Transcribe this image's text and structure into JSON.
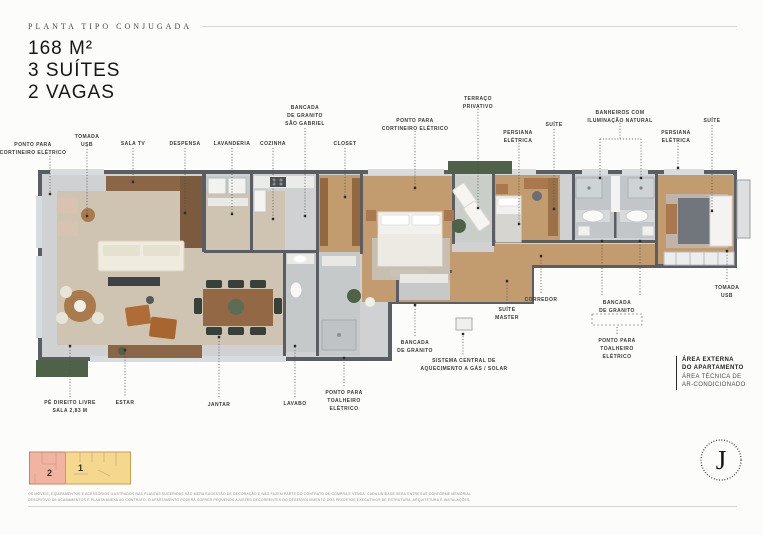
{
  "header": {
    "kicker": "PLANTA TIPO CONJUGADA",
    "area": "168 M²",
    "suites": "3 SUÍTES",
    "vagas": "2 VAGAS"
  },
  "palette": {
    "background": "#fcfcfa",
    "wall": "#5a5e62",
    "floor_gray": "#d0d1d2",
    "floor_bath": "#c6c9ca",
    "wood": "#c29b6e",
    "rug": "#cfc4b2",
    "sofa_cream": "#efebdf",
    "wood_furniture": "#9a6f45",
    "greenery": "#4e6247",
    "leader": "#4c4c4a",
    "keyplan_zone1": "#f6d78e",
    "keyplan_zone2": "#f1b4a0"
  },
  "callouts": [
    {
      "id": "ponto-cortineiro-eletrico-1",
      "lines": [
        "PONTO PARA",
        "CORTINEIRO ELÉTRICO"
      ],
      "x": 33,
      "y": 141,
      "segments": [
        [
          50,
          153,
          50,
          193
        ]
      ],
      "markers": [
        [
          50,
          194
        ]
      ]
    },
    {
      "id": "tomada-usb-1",
      "lines": [
        "TOMADA",
        "USB"
      ],
      "x": 87,
      "y": 133,
      "segments": [
        [
          87,
          146,
          87,
          215
        ]
      ],
      "markers": [
        [
          87,
          216
        ]
      ]
    },
    {
      "id": "sala-tv",
      "lines": [
        "SALA TV"
      ],
      "x": 133,
      "y": 140,
      "segments": [
        [
          133,
          148,
          133,
          181
        ]
      ],
      "markers": [
        [
          133,
          182
        ]
      ]
    },
    {
      "id": "despensa",
      "lines": [
        "DESPENSA"
      ],
      "x": 185,
      "y": 140,
      "segments": [
        [
          185,
          148,
          185,
          212
        ]
      ],
      "markers": [
        [
          185,
          213
        ]
      ]
    },
    {
      "id": "lavanderia",
      "lines": [
        "LAVANDERIA"
      ],
      "x": 232,
      "y": 140,
      "segments": [
        [
          232,
          148,
          232,
          213
        ]
      ],
      "markers": [
        [
          232,
          214
        ]
      ]
    },
    {
      "id": "cozinha",
      "lines": [
        "COZINHA"
      ],
      "x": 273,
      "y": 140,
      "segments": [
        [
          273,
          148,
          273,
          218
        ]
      ],
      "markers": [
        [
          273,
          219
        ]
      ]
    },
    {
      "id": "bancada-granito-sao-gabriel",
      "lines": [
        "BANCADA",
        "DE GRANITO",
        "SÃO GABRIEL"
      ],
      "x": 305,
      "y": 104,
      "segments": [
        [
          305,
          128,
          305,
          215
        ]
      ],
      "markers": [
        [
          305,
          216
        ]
      ]
    },
    {
      "id": "closet",
      "lines": [
        "CLOSET"
      ],
      "x": 345,
      "y": 140,
      "segments": [
        [
          345,
          148,
          345,
          196
        ]
      ],
      "markers": [
        [
          345,
          197
        ]
      ]
    },
    {
      "id": "ponto-cortineiro-eletrico-2",
      "lines": [
        "PONTO PARA",
        "CORTINEIRO ELÉTRICO"
      ],
      "x": 415,
      "y": 117,
      "segments": [
        [
          415,
          131,
          415,
          187
        ]
      ],
      "markers": [
        [
          415,
          188
        ]
      ]
    },
    {
      "id": "terraco-privativo",
      "lines": [
        "TERRAÇO",
        "PRIVATIVO"
      ],
      "x": 478,
      "y": 95,
      "segments": [
        [
          478,
          109,
          478,
          207
        ]
      ],
      "markers": [
        [
          478,
          208
        ]
      ]
    },
    {
      "id": "persiana-eletrica-1",
      "lines": [
        "PERSIANA",
        "ELÉTRICA"
      ],
      "x": 518,
      "y": 129,
      "segments": [
        [
          519,
          143,
          519,
          223
        ]
      ],
      "markers": [
        [
          519,
          224
        ]
      ]
    },
    {
      "id": "suite-label-1",
      "lines": [
        "SUÍTE"
      ],
      "x": 554,
      "y": 121,
      "segments": [
        [
          554,
          129,
          554,
          208
        ]
      ],
      "markers": [
        [
          554,
          209
        ]
      ]
    },
    {
      "id": "banheiros-iluminacao-natural",
      "lines": [
        "BANHEIROS COM",
        "ILUMINAÇÃO NATURAL"
      ],
      "x": 620,
      "y": 109,
      "segments": [
        [
          620,
          123,
          620,
          139
        ],
        [
          600,
          139,
          641,
          139
        ],
        [
          600,
          139,
          600,
          177
        ],
        [
          641,
          139,
          641,
          177
        ]
      ],
      "markers": [
        [
          600,
          178
        ],
        [
          641,
          178
        ]
      ]
    },
    {
      "id": "persiana-eletrica-2",
      "lines": [
        "PERSIANA",
        "ELÉTRICA"
      ],
      "x": 676,
      "y": 129,
      "segments": [
        [
          678,
          143,
          678,
          167
        ]
      ],
      "markers": [
        [
          678,
          168
        ]
      ]
    },
    {
      "id": "suite-label-2",
      "lines": [
        "SUÍTE"
      ],
      "x": 712,
      "y": 117,
      "segments": [
        [
          712,
          125,
          712,
          210
        ]
      ],
      "markers": [
        [
          712,
          211
        ]
      ]
    },
    {
      "id": "tomada-usb-2",
      "lines": [
        "TOMADA",
        "USB"
      ],
      "x": 727,
      "y": 284,
      "segments": [
        [
          727,
          252,
          727,
          282
        ]
      ],
      "markers": [
        [
          727,
          251
        ]
      ]
    },
    {
      "id": "corredor",
      "lines": [
        "CORREDOR"
      ],
      "x": 541,
      "y": 296,
      "segments": [
        [
          541,
          257,
          541,
          294
        ]
      ],
      "markers": [
        [
          541,
          256
        ]
      ]
    },
    {
      "id": "suite-master",
      "lines": [
        "SUÍTE",
        "MASTER"
      ],
      "x": 507,
      "y": 306,
      "segments": [
        [
          507,
          282,
          507,
          304
        ]
      ],
      "markers": [
        [
          507,
          281
        ]
      ]
    },
    {
      "id": "bancada-granito-2",
      "lines": [
        "BANCADA",
        "DE GRANITO"
      ],
      "x": 617,
      "y": 299,
      "segments": [
        [
          602,
          242,
          602,
          297
        ],
        [
          640,
          242,
          640,
          297
        ],
        [
          617,
          327,
          617,
          335
        ]
      ],
      "markers": [
        [
          602,
          241
        ],
        [
          640,
          241
        ]
      ]
    },
    {
      "id": "ponto-toalheiro-eletrico-2",
      "lines": [
        "PONTO PARA",
        "TOALHEIRO",
        "ELÉTRICO"
      ],
      "x": 617,
      "y": 337,
      "segments": [],
      "markers": []
    },
    {
      "id": "ponto-toalheiro-eletrico-1",
      "lines": [
        "PONTO PARA",
        "TOALHEIRO",
        "ELÉTRICO"
      ],
      "x": 344,
      "y": 389,
      "segments": [
        [
          344,
          359,
          344,
          387
        ]
      ],
      "markers": [
        [
          344,
          358
        ]
      ]
    },
    {
      "id": "lavabo",
      "lines": [
        "LAVABO"
      ],
      "x": 295,
      "y": 400,
      "segments": [
        [
          295,
          347,
          295,
          398
        ]
      ],
      "markers": [
        [
          295,
          346
        ]
      ]
    },
    {
      "id": "bancada-granito-1",
      "lines": [
        "BANCADA",
        "DE GRANITO"
      ],
      "x": 415,
      "y": 339,
      "segments": [
        [
          415,
          306,
          415,
          337
        ]
      ],
      "markers": [
        [
          415,
          305
        ]
      ]
    },
    {
      "id": "sistema-central-aquecimento",
      "lines": [
        "SISTEMA CENTRAL DE",
        "AQUECIMENTO A GÁS / SOLAR"
      ],
      "x": 464,
      "y": 357,
      "segments": [
        [
          463,
          336,
          463,
          355
        ]
      ],
      "markers": [
        [
          463,
          334
        ]
      ]
    },
    {
      "id": "pe-direito-livre",
      "lines": [
        "PÉ DIREITO LIVRE",
        "SALA 2,83 M"
      ],
      "x": 70,
      "y": 399,
      "segments": [
        [
          70,
          347,
          70,
          397
        ]
      ],
      "markers": [
        [
          70,
          346
        ]
      ]
    },
    {
      "id": "estar",
      "lines": [
        "ESTAR"
      ],
      "x": 125,
      "y": 399,
      "segments": [
        [
          125,
          351,
          125,
          397
        ]
      ],
      "markers": [
        [
          125,
          350
        ]
      ]
    },
    {
      "id": "jantar",
      "lines": [
        "JANTAR"
      ],
      "x": 219,
      "y": 401,
      "segments": [
        [
          219,
          338,
          219,
          399
        ]
      ],
      "markers": [
        [
          219,
          337
        ]
      ]
    }
  ],
  "area_note": {
    "l1": "ÁREA EXTERNA",
    "l2": "DO APARTAMENTO",
    "l3": "ÁREA TÉCNICA DE",
    "l4": "AR-CONDICIONADO"
  },
  "key_plan": {
    "zones": [
      {
        "label": "1",
        "color": "#f6d78e"
      },
      {
        "label": "2",
        "color": "#f1b4a0"
      }
    ]
  },
  "disclaimer": {
    "line1": "OS MÓVEIS, EQUIPAMENTOS E ACESSÓRIOS ILUSTRADOS NAS PLANTAS SUGERIDAS SÃO MERA SUGESTÃO DE DECORAÇÃO E NÃO FAZEM PARTE DO CONTRATO DE COMPRA E VENDA. CADA UNIDADE SERÁ ENTREGUE CONFORME MEMORIAL",
    "line2": "DESCRITIVO DE ACABAMENTOS E PLANTA ANEXA AO CONTRATO. O APARTAMENTO PODERÁ SOFRER PEQUENOS AJUSTES DECORRENTES DO DESENVOLVIMENTO DOS PROJETOS EXECUTIVOS DE ESTRUTURA, ARQUITETURA E INSTALAÇÕES."
  },
  "logo": {
    "letter": "J"
  }
}
